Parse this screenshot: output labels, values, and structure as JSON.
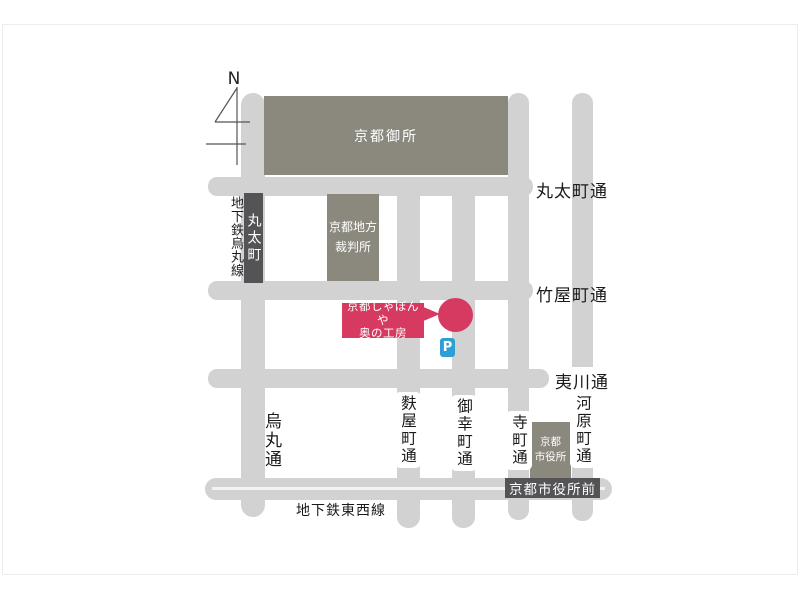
{
  "map": {
    "compass_label": "N",
    "landmarks": {
      "palace": "京都御所",
      "courthouse_line1": "京都地方",
      "courthouse_line2": "裁判所",
      "cityhall_line1": "京都",
      "cityhall_line2": "市役所"
    },
    "stations": {
      "marutamachi": "丸太町",
      "shiyakushomae": "京都市役所前"
    },
    "subway": {
      "karasuma_line": "地下鉄烏丸線",
      "tozai_line": "地下鉄東西線"
    },
    "streets": {
      "marutamachi_dori": "丸太町通",
      "takeyamachi_dori": "竹屋町通",
      "ebisugawa_dori": "夷川通",
      "karasuma_dori": "烏丸通",
      "fuyacho_dori": "麩屋町通",
      "gokomachi_dori": "御幸町通",
      "teramachi_dori": "寺町通",
      "kawaramachi_dori": "河原町通"
    },
    "poi": {
      "name_line1": "京都しゃぼんや",
      "name_line2": "奥の工房"
    },
    "parking_label": "P",
    "colors": {
      "street": "#d2d2d2",
      "building": "#8b887d",
      "station_badge": "#545456",
      "poi_red": "#d63a60",
      "parking_blue": "#2e9fd6"
    }
  }
}
